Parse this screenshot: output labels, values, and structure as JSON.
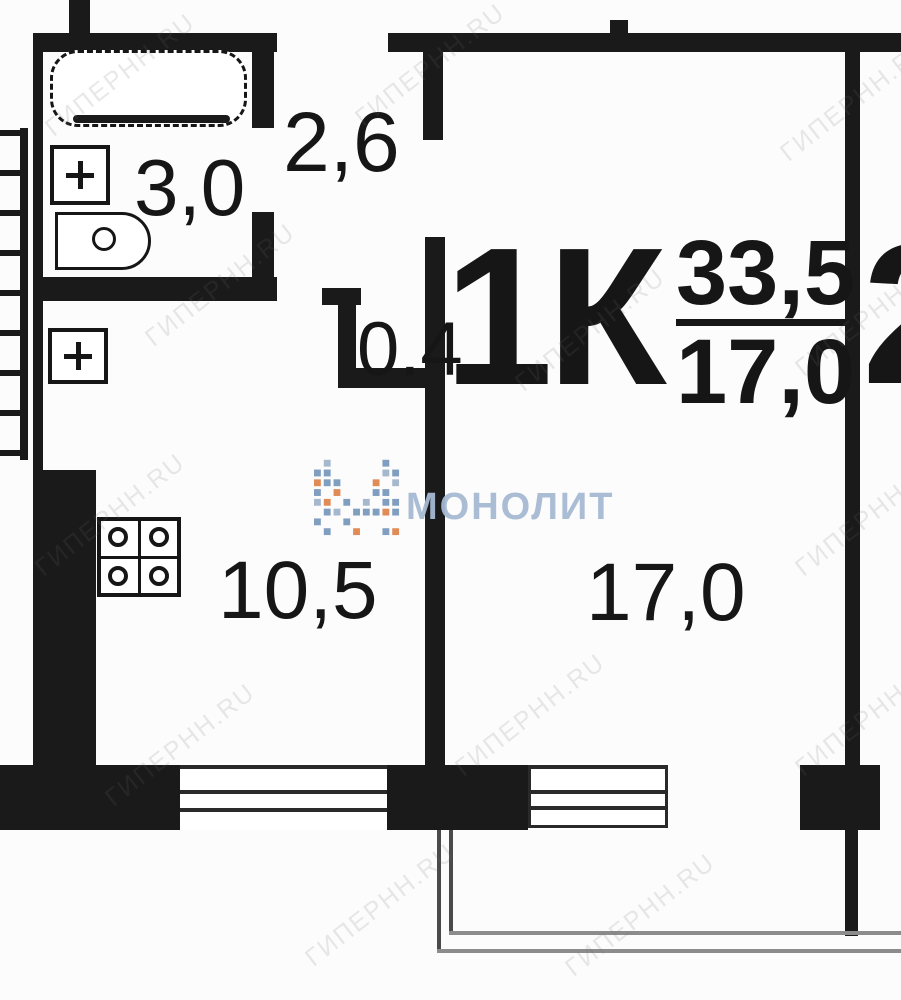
{
  "plan": {
    "apartment_type": "1К",
    "area_total": "33,5",
    "area_living_fraction": "17,0",
    "neighbor_label": "2",
    "labels": {
      "bathroom": "3,0",
      "hallway": "2,6",
      "closet": "0.4",
      "kitchen": "10,5",
      "living_room": "17,0"
    }
  },
  "watermark": {
    "brand": "МОНОЛИТ",
    "tile": "ГИПЕРНН.RU"
  },
  "colors": {
    "wall": "#1a1a1a",
    "background": "#fcfcfc",
    "brand_blue": "#a6bad2",
    "logo_blue": "#7a99bd",
    "logo_orange": "#e0874f",
    "balcony_line": "#8c8c8c"
  }
}
